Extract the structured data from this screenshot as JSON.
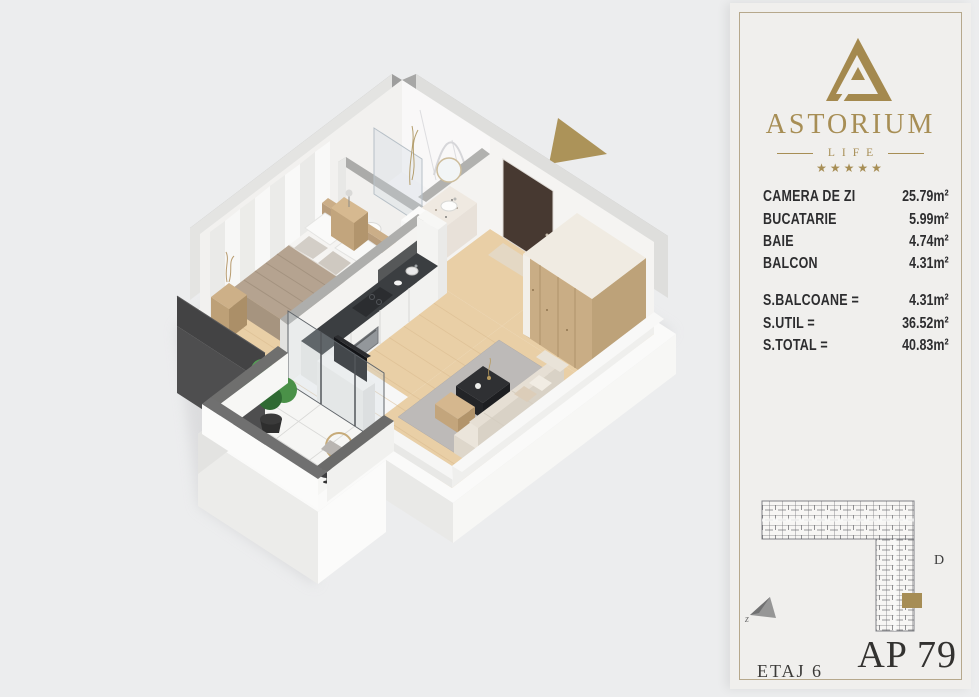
{
  "brand": {
    "name": "ASTORIUM",
    "tagline": "LIFE",
    "stars": "★★★★★"
  },
  "areas": {
    "rooms": [
      {
        "label": "CAMERA DE ZI",
        "value": "25.79m²"
      },
      {
        "label": "BUCATARIE",
        "value": "5.99m²"
      },
      {
        "label": "BAIE",
        "value": "4.74m²"
      },
      {
        "label": "BALCON",
        "value": "4.31m²"
      }
    ],
    "totals": [
      {
        "label": "S.BALCOANE =",
        "value": "4.31m²"
      },
      {
        "label": "S.UTIL =",
        "value": "36.52m²"
      },
      {
        "label": "S.TOTAL =",
        "value": "40.83m²"
      }
    ]
  },
  "footer": {
    "floor_label": "ETAJ 6",
    "apartment_label": "AP 79"
  },
  "site_plan": {
    "section_label": "D",
    "compass_label": "z"
  },
  "palette": {
    "gold": "#a78e55",
    "dark_text": "#2d2d2f",
    "card_bg": "#f0efed",
    "page_bg": "#ecedee",
    "highlight_unit": "#a68d55",
    "north_arrow": "#ac9359",
    "wood_floor": "#e9cfa6",
    "wall_dark": "#4e4e4f"
  }
}
